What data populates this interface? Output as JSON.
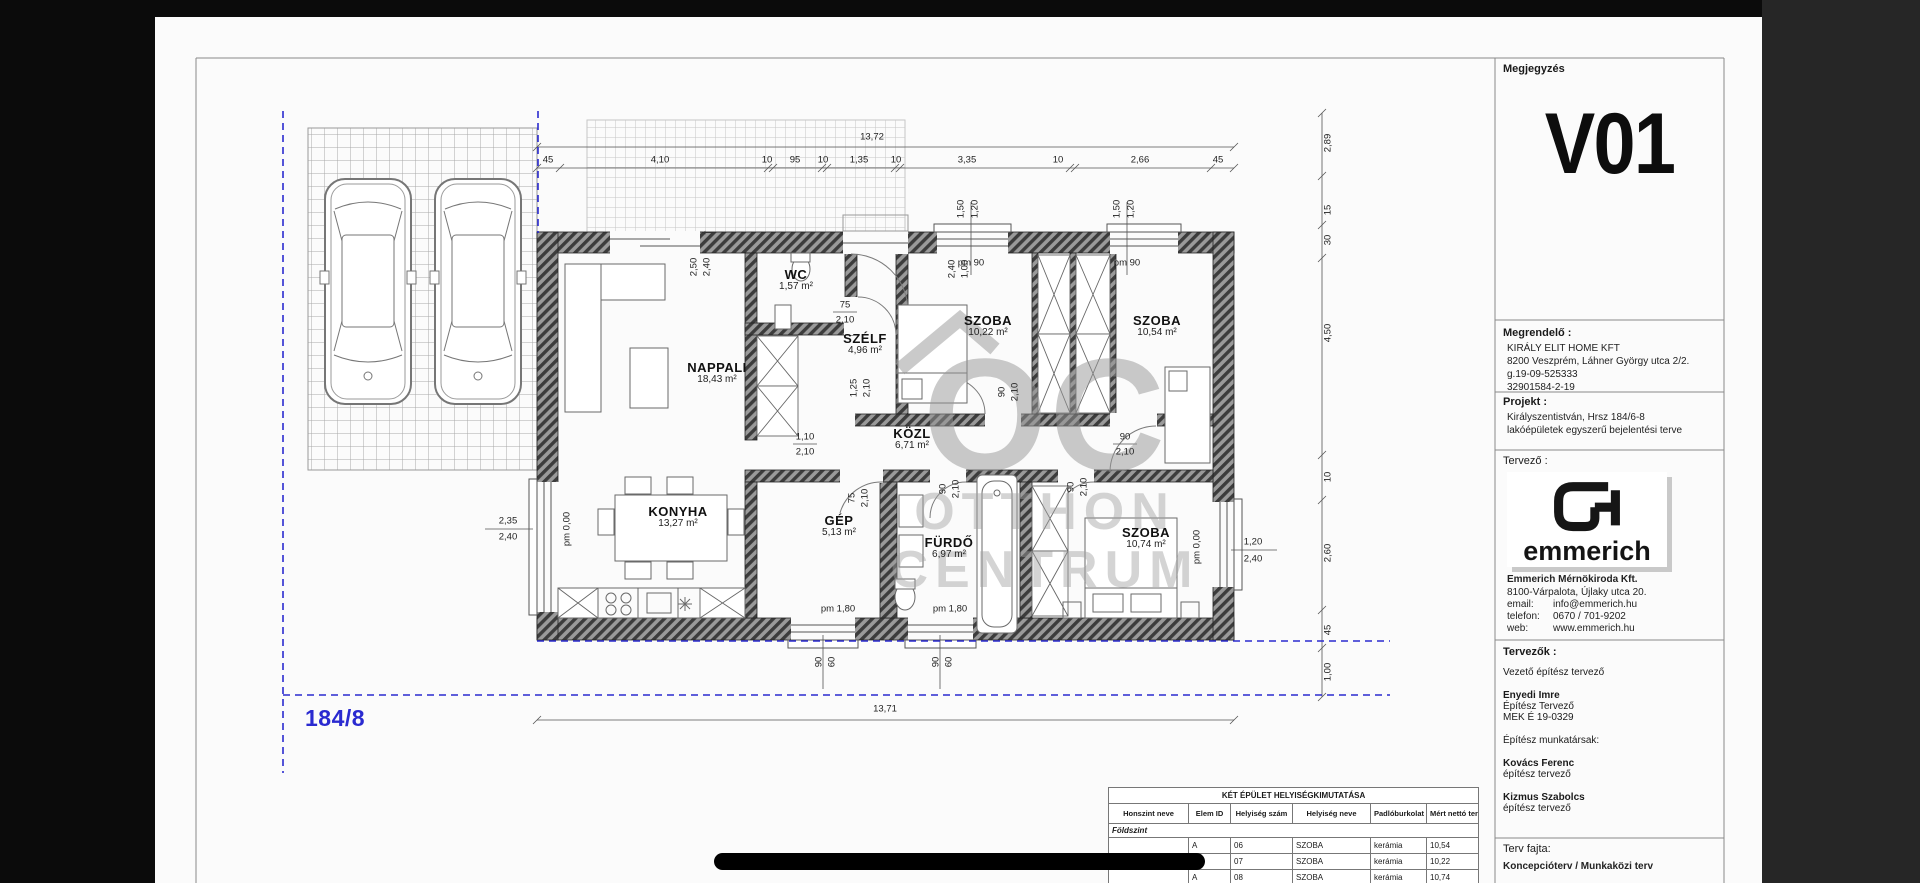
{
  "titleblock": {
    "notes_label": "Megjegyzés",
    "version": "V01",
    "client_label": "Megrendelő :",
    "client_lines": [
      "KIRÁLY ELIT HOME KFT",
      "8200 Veszprém, Láhner György utca 2/2.",
      "g.19-09-525333",
      "32901584-2-19"
    ],
    "project_label": "Projekt :",
    "project_lines": [
      "Királyszentistván, Hrsz 184/6-8",
      "lakóépületek egyszerű bejelentési terve"
    ],
    "designer_label": "Tervező :",
    "logo_word": "emmerich",
    "firm_name": "Emmerich Mérnökiroda Kft.",
    "firm_address": "8100-Várpalota, Újlaky utca 20.",
    "contacts": [
      [
        "email:",
        "info@emmerich.hu"
      ],
      [
        "telefon:",
        "0670 / 701-9202"
      ],
      [
        "web:",
        "www.emmerich.hu"
      ]
    ],
    "team_label": "Tervezők :",
    "team_lines": [
      {
        "t": "Vezető építész tervező",
        "b": 0,
        "gap": 1
      },
      {
        "t": "Enyedi Imre",
        "b": 1
      },
      {
        "t": "Építész Tervező",
        "b": 0
      },
      {
        "t": "MEK É 19-0329",
        "b": 0,
        "gap": 1
      },
      {
        "t": "Építész munkatársak:",
        "b": 0,
        "gap": 1
      },
      {
        "t": "Kovács Ferenc",
        "b": 1
      },
      {
        "t": "építész tervező",
        "b": 0,
        "gap": 1
      },
      {
        "t": "Kizmus Szabolcs",
        "b": 1
      },
      {
        "t": "építész tervező",
        "b": 0
      }
    ],
    "plan_type_label": "Terv fajta:",
    "plan_type": "Koncepcióterv / Munkaközi terv"
  },
  "table": {
    "title": "KÉT ÉPÜLET HELYISÉGKIMUTATÁSA",
    "headers": [
      "Honszint neve",
      "Elem ID",
      "Helyiség szám",
      "Helyiség neve",
      "Padlóburkolat",
      "Mért nettó ter..."
    ],
    "group": "Földszint",
    "rows": [
      [
        "A",
        "06",
        "SZOBA",
        "kerámia",
        "10,54"
      ],
      [
        "",
        "07",
        "SZOBA",
        "kerámia",
        "10,22"
      ],
      [
        "A",
        "08",
        "SZOBA",
        "kerámia",
        "10,74"
      ]
    ]
  },
  "plan": {
    "parcel": "184/8",
    "entry_arrow": "←",
    "watermark": [
      "OC",
      "OTTHON",
      "CENTRUM"
    ],
    "rooms": [
      {
        "n": "NAPPALI",
        "a": "18,43 m²",
        "x": 562,
        "y": 356
      },
      {
        "n": "WC",
        "a": "1,57 m²",
        "x": 641,
        "y": 263
      },
      {
        "n": "SZÉLF",
        "a": "4,96 m²",
        "x": 710,
        "y": 327
      },
      {
        "n": "SZOBA",
        "a": "10,22 m²",
        "x": 833,
        "y": 309
      },
      {
        "n": "SZOBA",
        "a": "10,54 m²",
        "x": 1002,
        "y": 309
      },
      {
        "n": "KÖZL",
        "a": "6,71 m²",
        "x": 757,
        "y": 422
      },
      {
        "n": "KONYHA",
        "a": "13,27 m²",
        "x": 523,
        "y": 500
      },
      {
        "n": "GÉP",
        "a": "5,13 m²",
        "x": 684,
        "y": 509
      },
      {
        "n": "FÜRDŐ",
        "a": "6,97 m²",
        "x": 794,
        "y": 531
      },
      {
        "n": "SZOBA",
        "a": "10,74 m²",
        "x": 991,
        "y": 521
      }
    ],
    "dims": [
      {
        "t": "45",
        "x": 393,
        "y": 143
      },
      {
        "t": "4,10",
        "x": 505,
        "y": 143
      },
      {
        "t": "10",
        "x": 612,
        "y": 143
      },
      {
        "t": "95",
        "x": 640,
        "y": 143
      },
      {
        "t": "10",
        "x": 668,
        "y": 143
      },
      {
        "t": "1,35",
        "x": 704,
        "y": 143
      },
      {
        "t": "10",
        "x": 741,
        "y": 143
      },
      {
        "t": "3,35",
        "x": 812,
        "y": 143
      },
      {
        "t": "10",
        "x": 903,
        "y": 143
      },
      {
        "t": "2,66",
        "x": 985,
        "y": 143
      },
      {
        "t": "45",
        "x": 1063,
        "y": 143
      },
      {
        "t": "13,72",
        "x": 717,
        "y": 120
      },
      {
        "t": "13,71",
        "x": 730,
        "y": 692
      },
      {
        "t": "2,89",
        "x": 1173,
        "y": 126,
        "r": 1
      },
      {
        "t": "15",
        "x": 1173,
        "y": 193,
        "r": 1
      },
      {
        "t": "30",
        "x": 1173,
        "y": 223,
        "r": 1
      },
      {
        "t": "4,50",
        "x": 1173,
        "y": 316,
        "r": 1
      },
      {
        "t": "10",
        "x": 1173,
        "y": 460,
        "r": 1
      },
      {
        "t": "2,60",
        "x": 1173,
        "y": 536,
        "r": 1
      },
      {
        "t": "45",
        "x": 1173,
        "y": 613,
        "r": 1
      },
      {
        "t": "1,00",
        "x": 1173,
        "y": 655,
        "r": 1
      },
      {
        "t": "2,35",
        "x": 353,
        "y": 504
      },
      {
        "t": "2,40",
        "x": 353,
        "y": 520
      },
      {
        "t": "pm 0,00",
        "x": 412,
        "y": 512,
        "r": 1
      },
      {
        "t": "pm 0,00",
        "x": 1042,
        "y": 530,
        "r": 1
      },
      {
        "t": "1,20",
        "x": 1098,
        "y": 525
      },
      {
        "t": "2,40",
        "x": 1098,
        "y": 542
      },
      {
        "t": "pm 90",
        "x": 816,
        "y": 246
      },
      {
        "t": "pm 90",
        "x": 972,
        "y": 246
      },
      {
        "t": "1,50",
        "x": 806,
        "y": 192,
        "r": 1
      },
      {
        "t": "1,20",
        "x": 820,
        "y": 192,
        "r": 1
      },
      {
        "t": "1,50",
        "x": 962,
        "y": 192,
        "r": 1
      },
      {
        "t": "1,20",
        "x": 976,
        "y": 192,
        "r": 1
      },
      {
        "t": "pm 1,80",
        "x": 683,
        "y": 592
      },
      {
        "t": "pm 1,80",
        "x": 795,
        "y": 592
      },
      {
        "t": "90",
        "x": 664,
        "y": 645,
        "r": 1
      },
      {
        "t": "60",
        "x": 677,
        "y": 645,
        "r": 1
      },
      {
        "t": "90",
        "x": 781,
        "y": 645,
        "r": 1
      },
      {
        "t": "60",
        "x": 794,
        "y": 645,
        "r": 1
      },
      {
        "t": "75",
        "x": 690,
        "y": 288
      },
      {
        "t": "2,10",
        "x": 690,
        "y": 303
      },
      {
        "t": "2,50",
        "x": 539,
        "y": 250,
        "r": 1
      },
      {
        "t": "2,40",
        "x": 552,
        "y": 250,
        "r": 1
      },
      {
        "t": "2,40",
        "x": 797,
        "y": 252,
        "r": 1
      },
      {
        "t": "1,00",
        "x": 810,
        "y": 252,
        "r": 1
      },
      {
        "t": "1,25",
        "x": 699,
        "y": 371,
        "r": 1
      },
      {
        "t": "2,10",
        "x": 712,
        "y": 371,
        "r": 1
      },
      {
        "t": "1,10",
        "x": 650,
        "y": 420
      },
      {
        "t": "2,10",
        "x": 650,
        "y": 435
      },
      {
        "t": "90",
        "x": 847,
        "y": 375,
        "r": 1
      },
      {
        "t": "2,10",
        "x": 860,
        "y": 375,
        "r": 1
      },
      {
        "t": "90",
        "x": 970,
        "y": 420
      },
      {
        "t": "2,10",
        "x": 970,
        "y": 435
      },
      {
        "t": "90",
        "x": 788,
        "y": 472,
        "r": 1
      },
      {
        "t": "2,10",
        "x": 801,
        "y": 472,
        "r": 1
      },
      {
        "t": "90",
        "x": 916,
        "y": 470,
        "r": 1
      },
      {
        "t": "2,10",
        "x": 929,
        "y": 470,
        "r": 1
      },
      {
        "t": "75",
        "x": 697,
        "y": 481,
        "r": 1
      },
      {
        "t": "2,10",
        "x": 710,
        "y": 481,
        "r": 1
      }
    ]
  }
}
